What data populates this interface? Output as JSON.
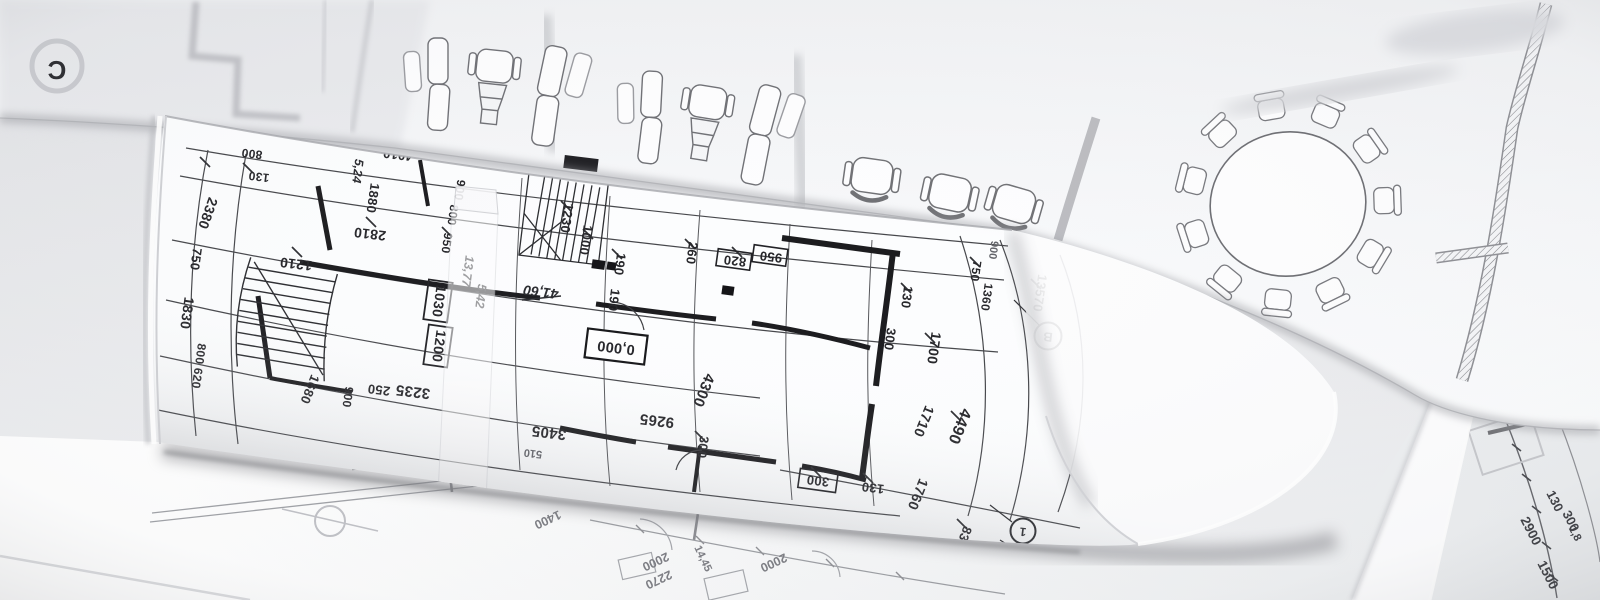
{
  "colors": {
    "background": "#dfe0e3",
    "paper_white": "#fbfcfd",
    "plan_line_dark": "#26262a",
    "plan_line_faint": "#a3a5aa",
    "shadow": "#7b7c81"
  },
  "front_roll": {
    "elevation": "0,000",
    "levels": {
      "l1": "41,60",
      "l2": "13,77",
      "l3": "5,42",
      "l4": "5,24"
    },
    "bubbles": {
      "b": "B",
      "n1": "1",
      "n2": "2"
    },
    "dims": [
      "4010",
      "1880",
      "2810",
      "1210",
      "800",
      "130",
      "950",
      "800",
      "900",
      "1230",
      "1000",
      "190",
      "190",
      "260",
      "820",
      "950",
      "130",
      "300",
      "1700",
      "750",
      "1360",
      "900",
      "13570",
      "2380",
      "750",
      "1830",
      "800 620",
      "1680",
      "900",
      "250",
      "3235",
      "1030",
      "1200",
      "510",
      "3405",
      "9265",
      "4300",
      "300",
      "300",
      "130",
      "1760",
      "1710",
      "4490",
      "830"
    ]
  },
  "background_sheet": {
    "bubble_c": "C"
  },
  "table_sheet": {
    "dims": [
      "1400",
      "2000",
      "2270",
      "14,45",
      "2000"
    ],
    "dims_right": [
      "130",
      "300",
      "2900",
      "1,8",
      "1500"
    ]
  }
}
